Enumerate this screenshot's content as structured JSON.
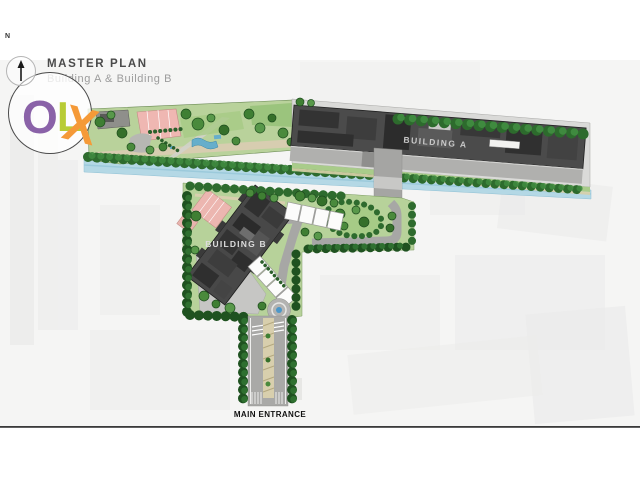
{
  "header": {
    "title": "MASTER PLAN",
    "subtitle": "Building A & Building B"
  },
  "compass": {
    "label": "N"
  },
  "watermark": {
    "letter_o": "O",
    "letter_l": "L",
    "letter_x": "X"
  },
  "plan": {
    "building_a": {
      "label": "BUILDING A"
    },
    "building_b": {
      "label": "BUILDING B"
    },
    "entrance": {
      "label": "MAIN ENTRANCE"
    }
  },
  "palette": {
    "building_fill": "#4b4b4b",
    "lawn_green": "#b7d29a",
    "tree_dark": "#1f5220",
    "tree_medium": "#2e6b2e",
    "tree_light": "#3f8a3f",
    "water_blue": "#b4d8e5",
    "road_gray": "#a7a7a5",
    "plaza_gray": "#c6c6c4",
    "canopy_pink": "#ecb6b0",
    "canopy_white": "#fcfcfb",
    "path_tan": "#d8cfad",
    "logo_o_purple": "#8a62a8",
    "logo_l_lime": "#b8cc35",
    "logo_x_orange": "#f59a38",
    "rule_line": "#3a3a3a"
  }
}
